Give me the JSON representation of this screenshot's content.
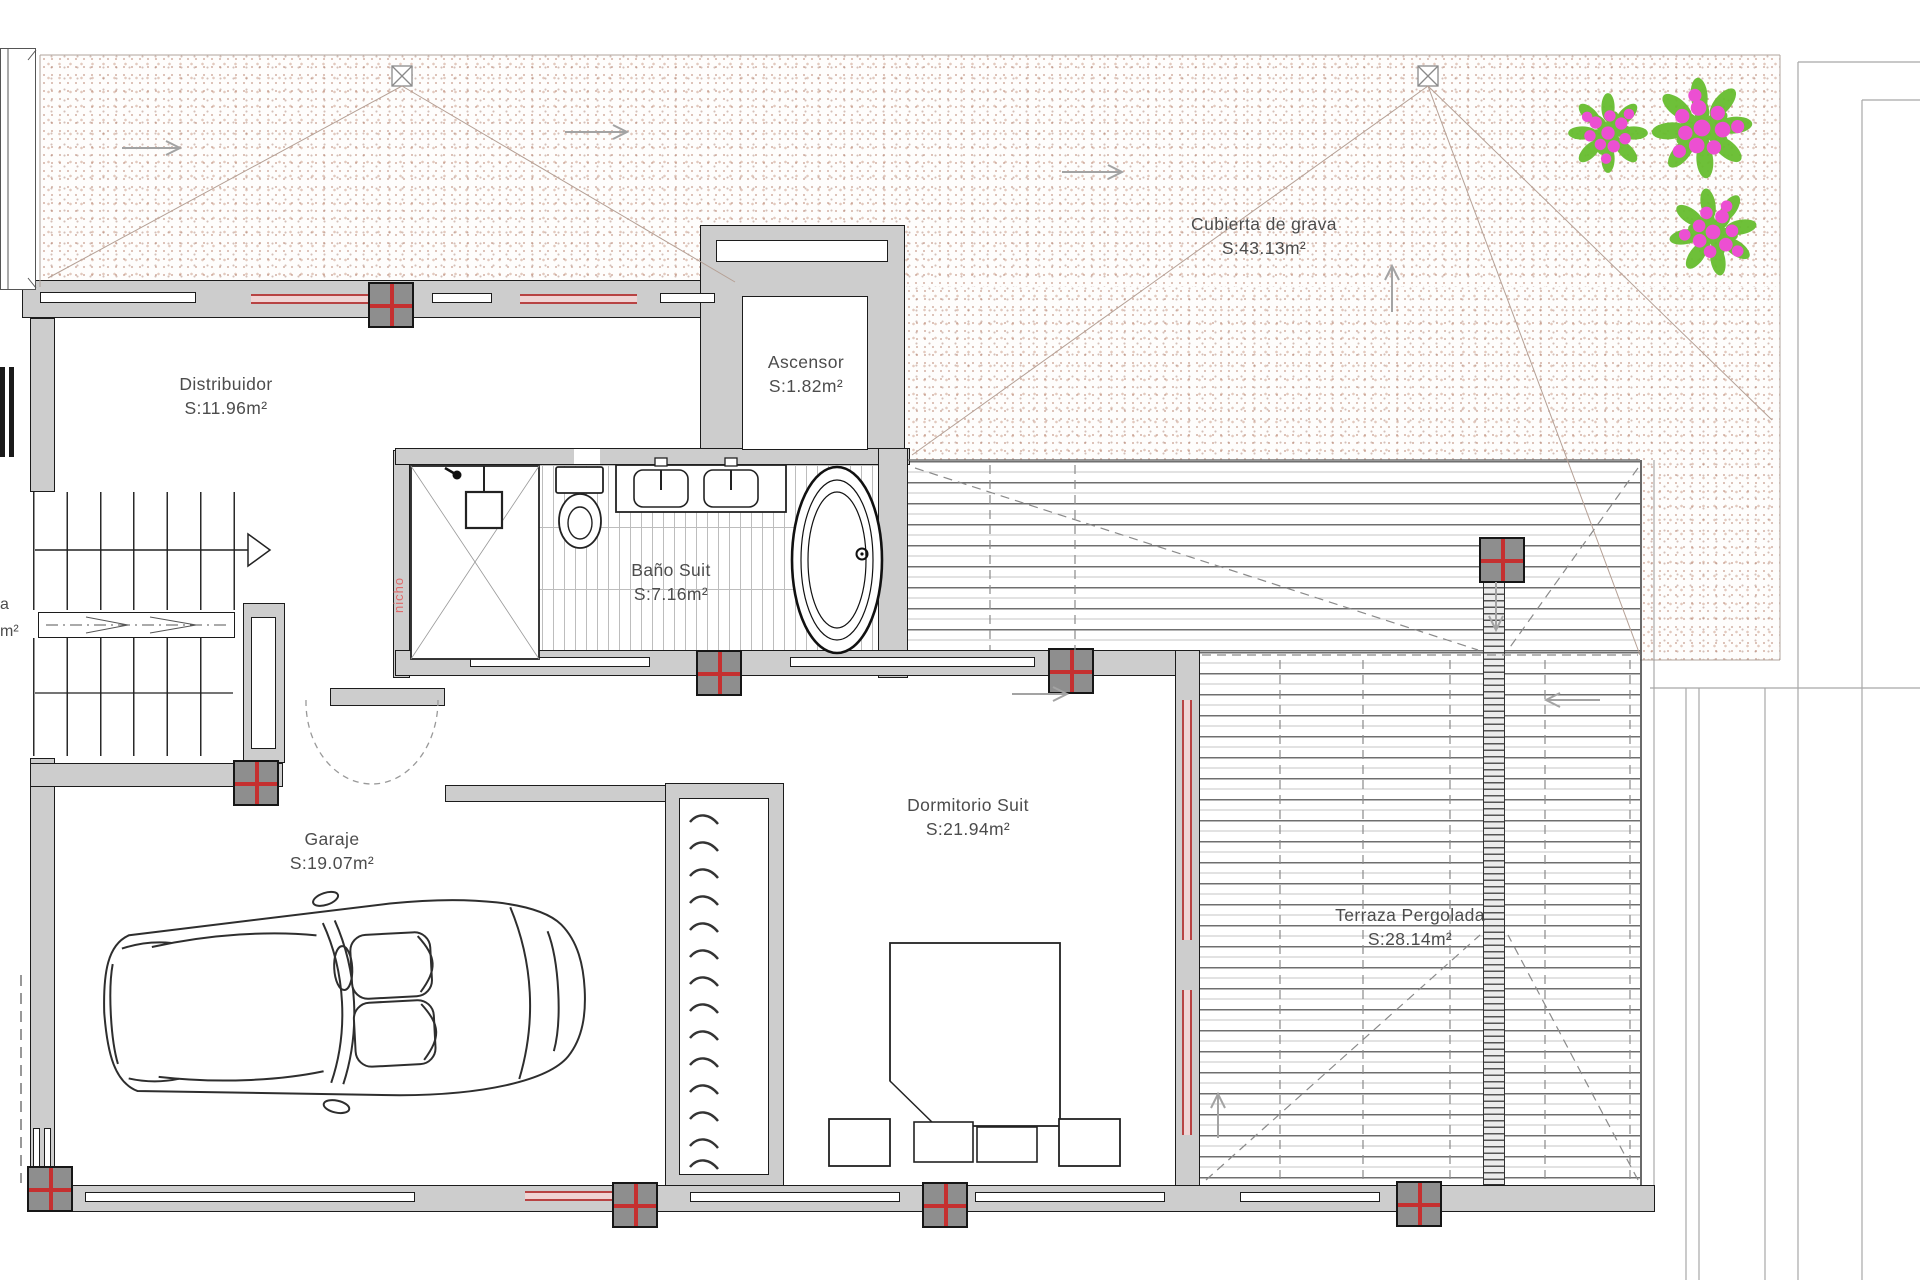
{
  "rooms": {
    "cubierta": {
      "name": "Cubierta de grava",
      "area": "S:43.13m²"
    },
    "distribuidor": {
      "name": "Distribuidor",
      "area": "S:11.96m²"
    },
    "ascensor": {
      "name": "Ascensor",
      "area": "S:1.82m²"
    },
    "bano": {
      "name": "Baño Suit",
      "area": "S:7.16m²"
    },
    "dormitorio": {
      "name": "Dormitorio Suit",
      "area": "S:21.94m²"
    },
    "garaje": {
      "name": "Garaje",
      "area": "S:19.07m²"
    },
    "terraza": {
      "name": "Terraza Pergolada",
      "area": "S:28.14m²"
    }
  },
  "annotations": {
    "niche_label": "nicho",
    "edge_label_fragment_top": "a",
    "edge_label_fragment_bottom": "m²"
  },
  "colors": {
    "wall_fill": "#cdcdcd",
    "wall_outline": "#1c1c1c",
    "column_fill": "#8e8e8e",
    "column_cross_red": "#c53030",
    "glazing_fill": "#f0d4d4",
    "glazing_red": "#b84343",
    "gravel_dot": "#b07660",
    "pergola_line": "#6f6f6f",
    "leaf_green": "#67bd2f",
    "flower_pink": "#ec4fd2",
    "label_text": "#4c4c4c",
    "niche_red": "#e06a6a",
    "guide_gray": "#a3a3a3"
  }
}
